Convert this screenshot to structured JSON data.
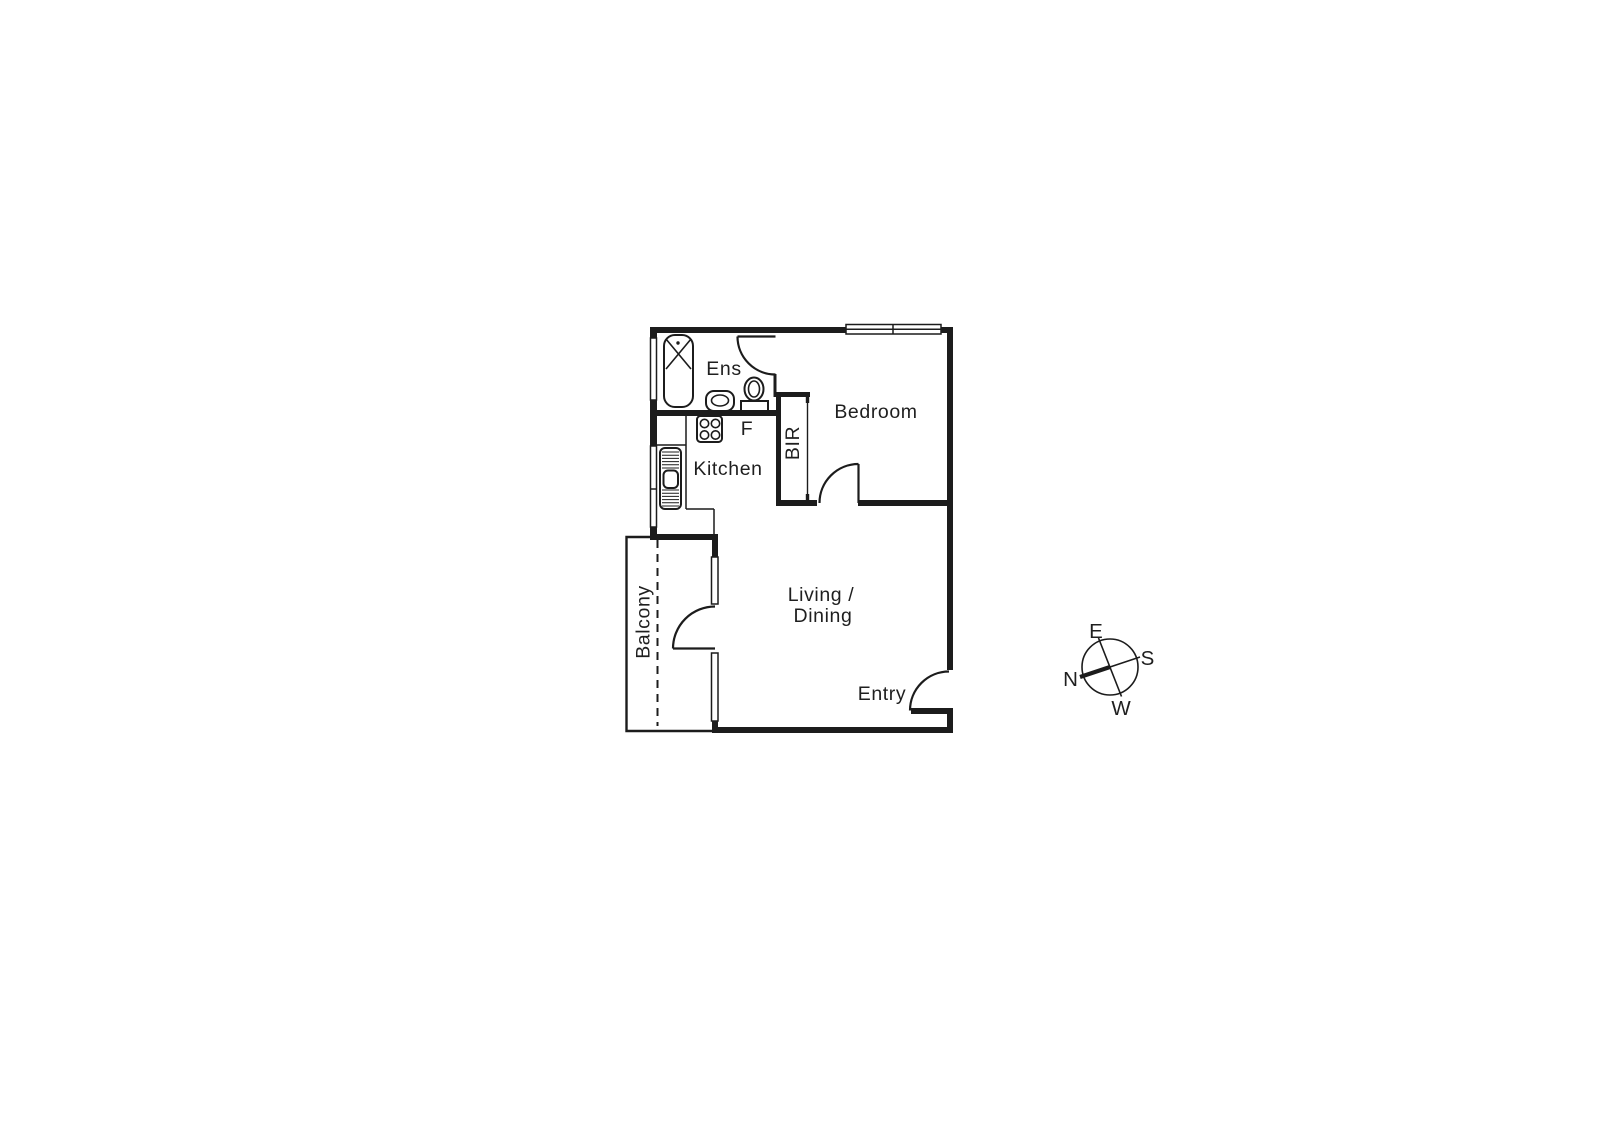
{
  "plan": {
    "labels": {
      "ens": "Ens",
      "fridge": "F",
      "kitchen": "Kitchen",
      "bir": "BIR",
      "bedroom": "Bedroom",
      "living1": "Living /",
      "living2": "Dining",
      "entry": "Entry",
      "balcony": "Balcony"
    },
    "colors": {
      "line": "#1c1c1c",
      "background": "#ffffff"
    }
  },
  "compass": {
    "east": "E",
    "south": "S",
    "north": "N",
    "west": "W"
  }
}
